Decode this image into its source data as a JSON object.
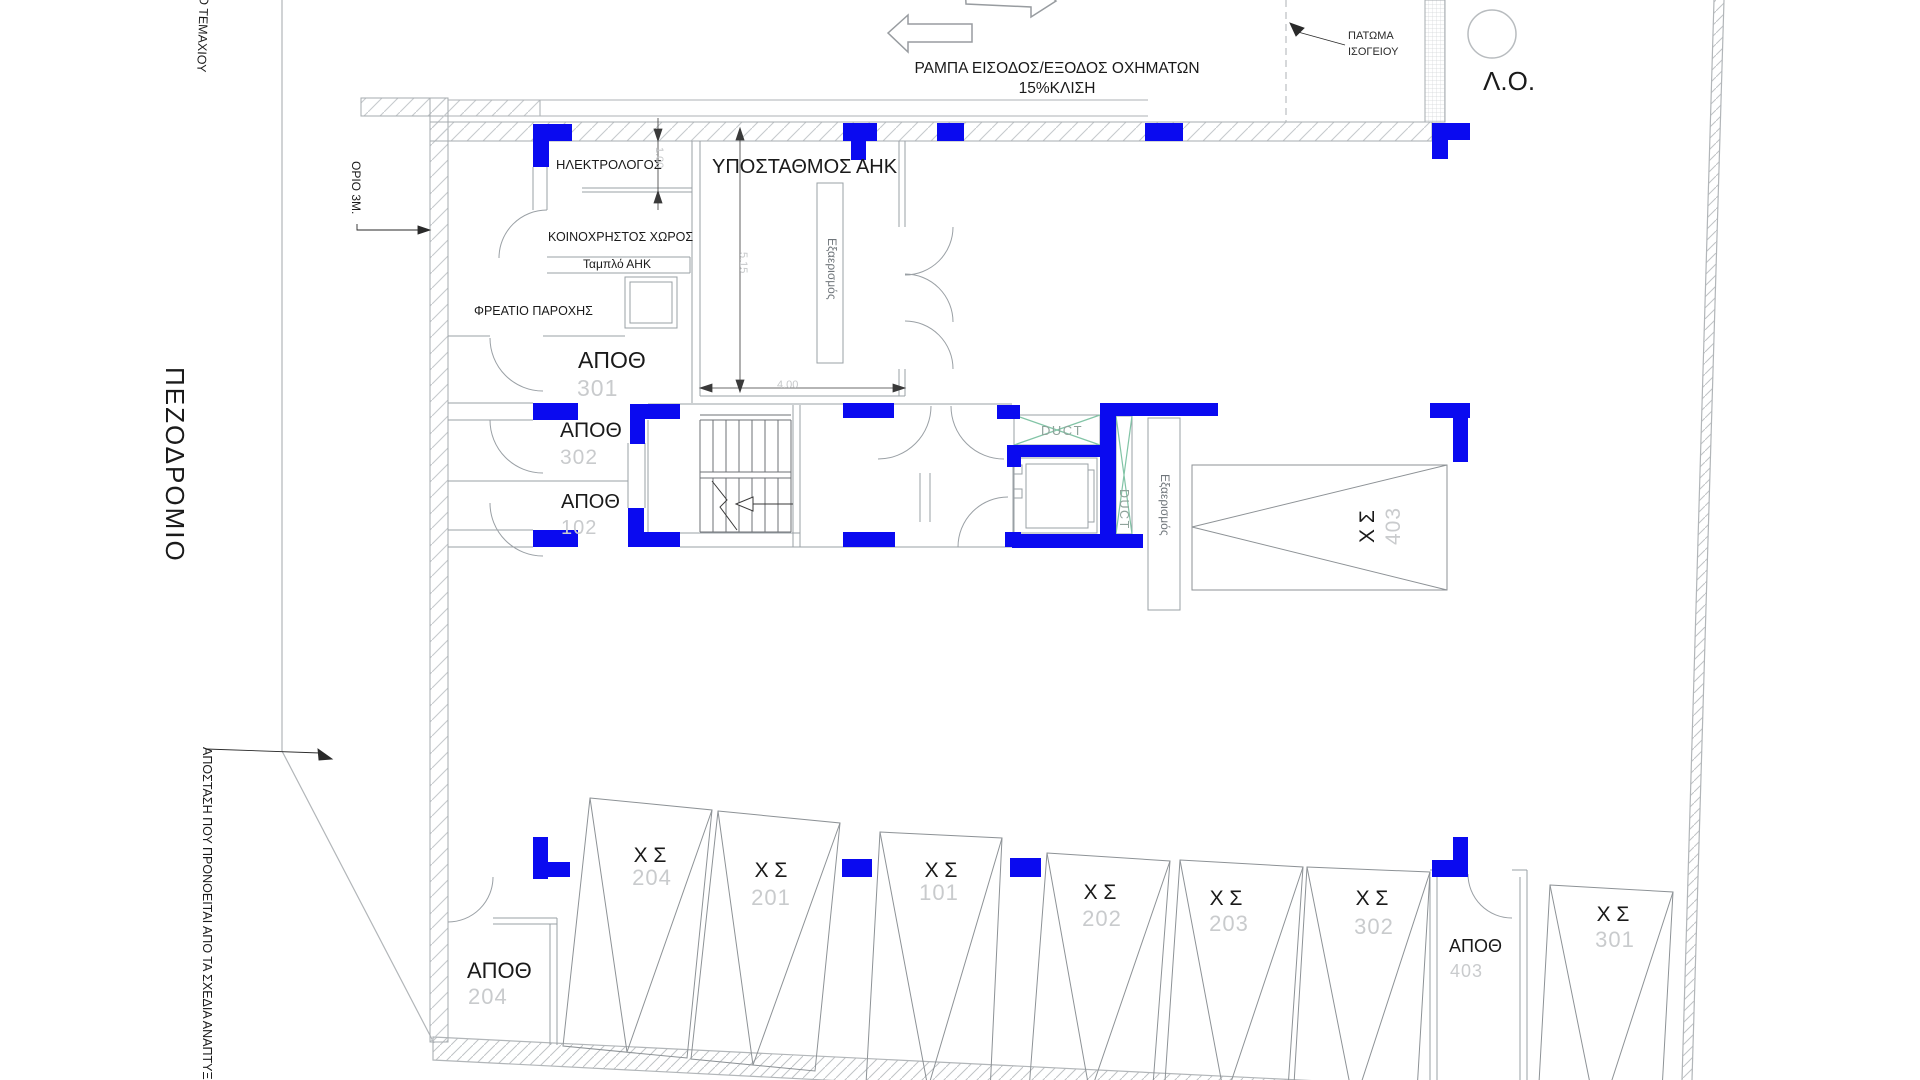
{
  "colors": {
    "column_blue": "#0a0af0",
    "duct_green": "#82c4a6",
    "duct_text": "#8fa39b",
    "number_grey": "#c9cbcd",
    "dim_grey": "#c6c8ca",
    "line_grey": "#9aa0a5"
  },
  "ramp": {
    "line1": "ΡΑΜΠΑ ΕΙΣΟΔΟΣ/ΕΞΟΔΟΣ ΟΧΗΜΑΤΩΝ",
    "line2": "15%ΚΛΙΣΗ",
    "floor_note1": "ΠΑΤΩΜΑ",
    "floor_note2": "ΙΣΟΓΕΙΟΥ",
    "lo": "Λ.Ο."
  },
  "site": {
    "parcel": "ΙΟ ΤΕΜΑΧΙΟΥ",
    "offset3m": "ΟΡΙΟ 3Μ.",
    "sidewalk": "ΠΕΖΟΔΡΟΜΙΟ",
    "distance_note": "ΑΠΟΣΤΑΣΗ ΠΟΥ ΠΡΟΝΟΕΙΤΑΙ ΑΠΟ ΤΑ ΣΧΕΔΙΑ ΑΝΑΠΤΥΞ"
  },
  "rooms": {
    "electrician": "ΗΛΕΚΤΡΟΛΟΓΟΣ",
    "substation": "ΥΠΟΣΤΑΘΜΟΣ ΑΗΚ",
    "common": "ΚΟΙΝΟΧΡΗΣΤΟΣ ΧΩΡΟΣ",
    "panel": "Ταμπλό ΑΗΚ",
    "pit": "ΦΡΕΑΤΙΟ ΠΑΡΟΧΗΣ",
    "vent": "Εξαερισμός",
    "duct": "DUCT"
  },
  "dims": {
    "wall_offset": "1.00",
    "room_depth": "5.15",
    "room_width": "4.00"
  },
  "storage": {
    "s301": {
      "label": "ΑΠΟΘ",
      "num": "301"
    },
    "s302": {
      "label": "ΑΠΟΘ",
      "num": "302"
    },
    "s102": {
      "label": "ΑΠΟΘ",
      "num": "102"
    },
    "s204": {
      "label": "ΑΠΟΘ",
      "num": "204"
    },
    "s403": {
      "label": "ΑΠΟΘ",
      "num": "403"
    }
  },
  "parking": {
    "p403": {
      "label": "Χ Σ",
      "num": "403"
    },
    "p204": {
      "label": "Χ Σ",
      "num": "204"
    },
    "p201": {
      "label": "Χ Σ",
      "num": "201"
    },
    "p101": {
      "label": "Χ Σ",
      "num": "101"
    },
    "p202": {
      "label": "Χ Σ",
      "num": "202"
    },
    "p203": {
      "label": "Χ Σ",
      "num": "203"
    },
    "p302": {
      "label": "Χ Σ",
      "num": "302"
    },
    "p301": {
      "label": "Χ Σ",
      "num": "301"
    }
  }
}
